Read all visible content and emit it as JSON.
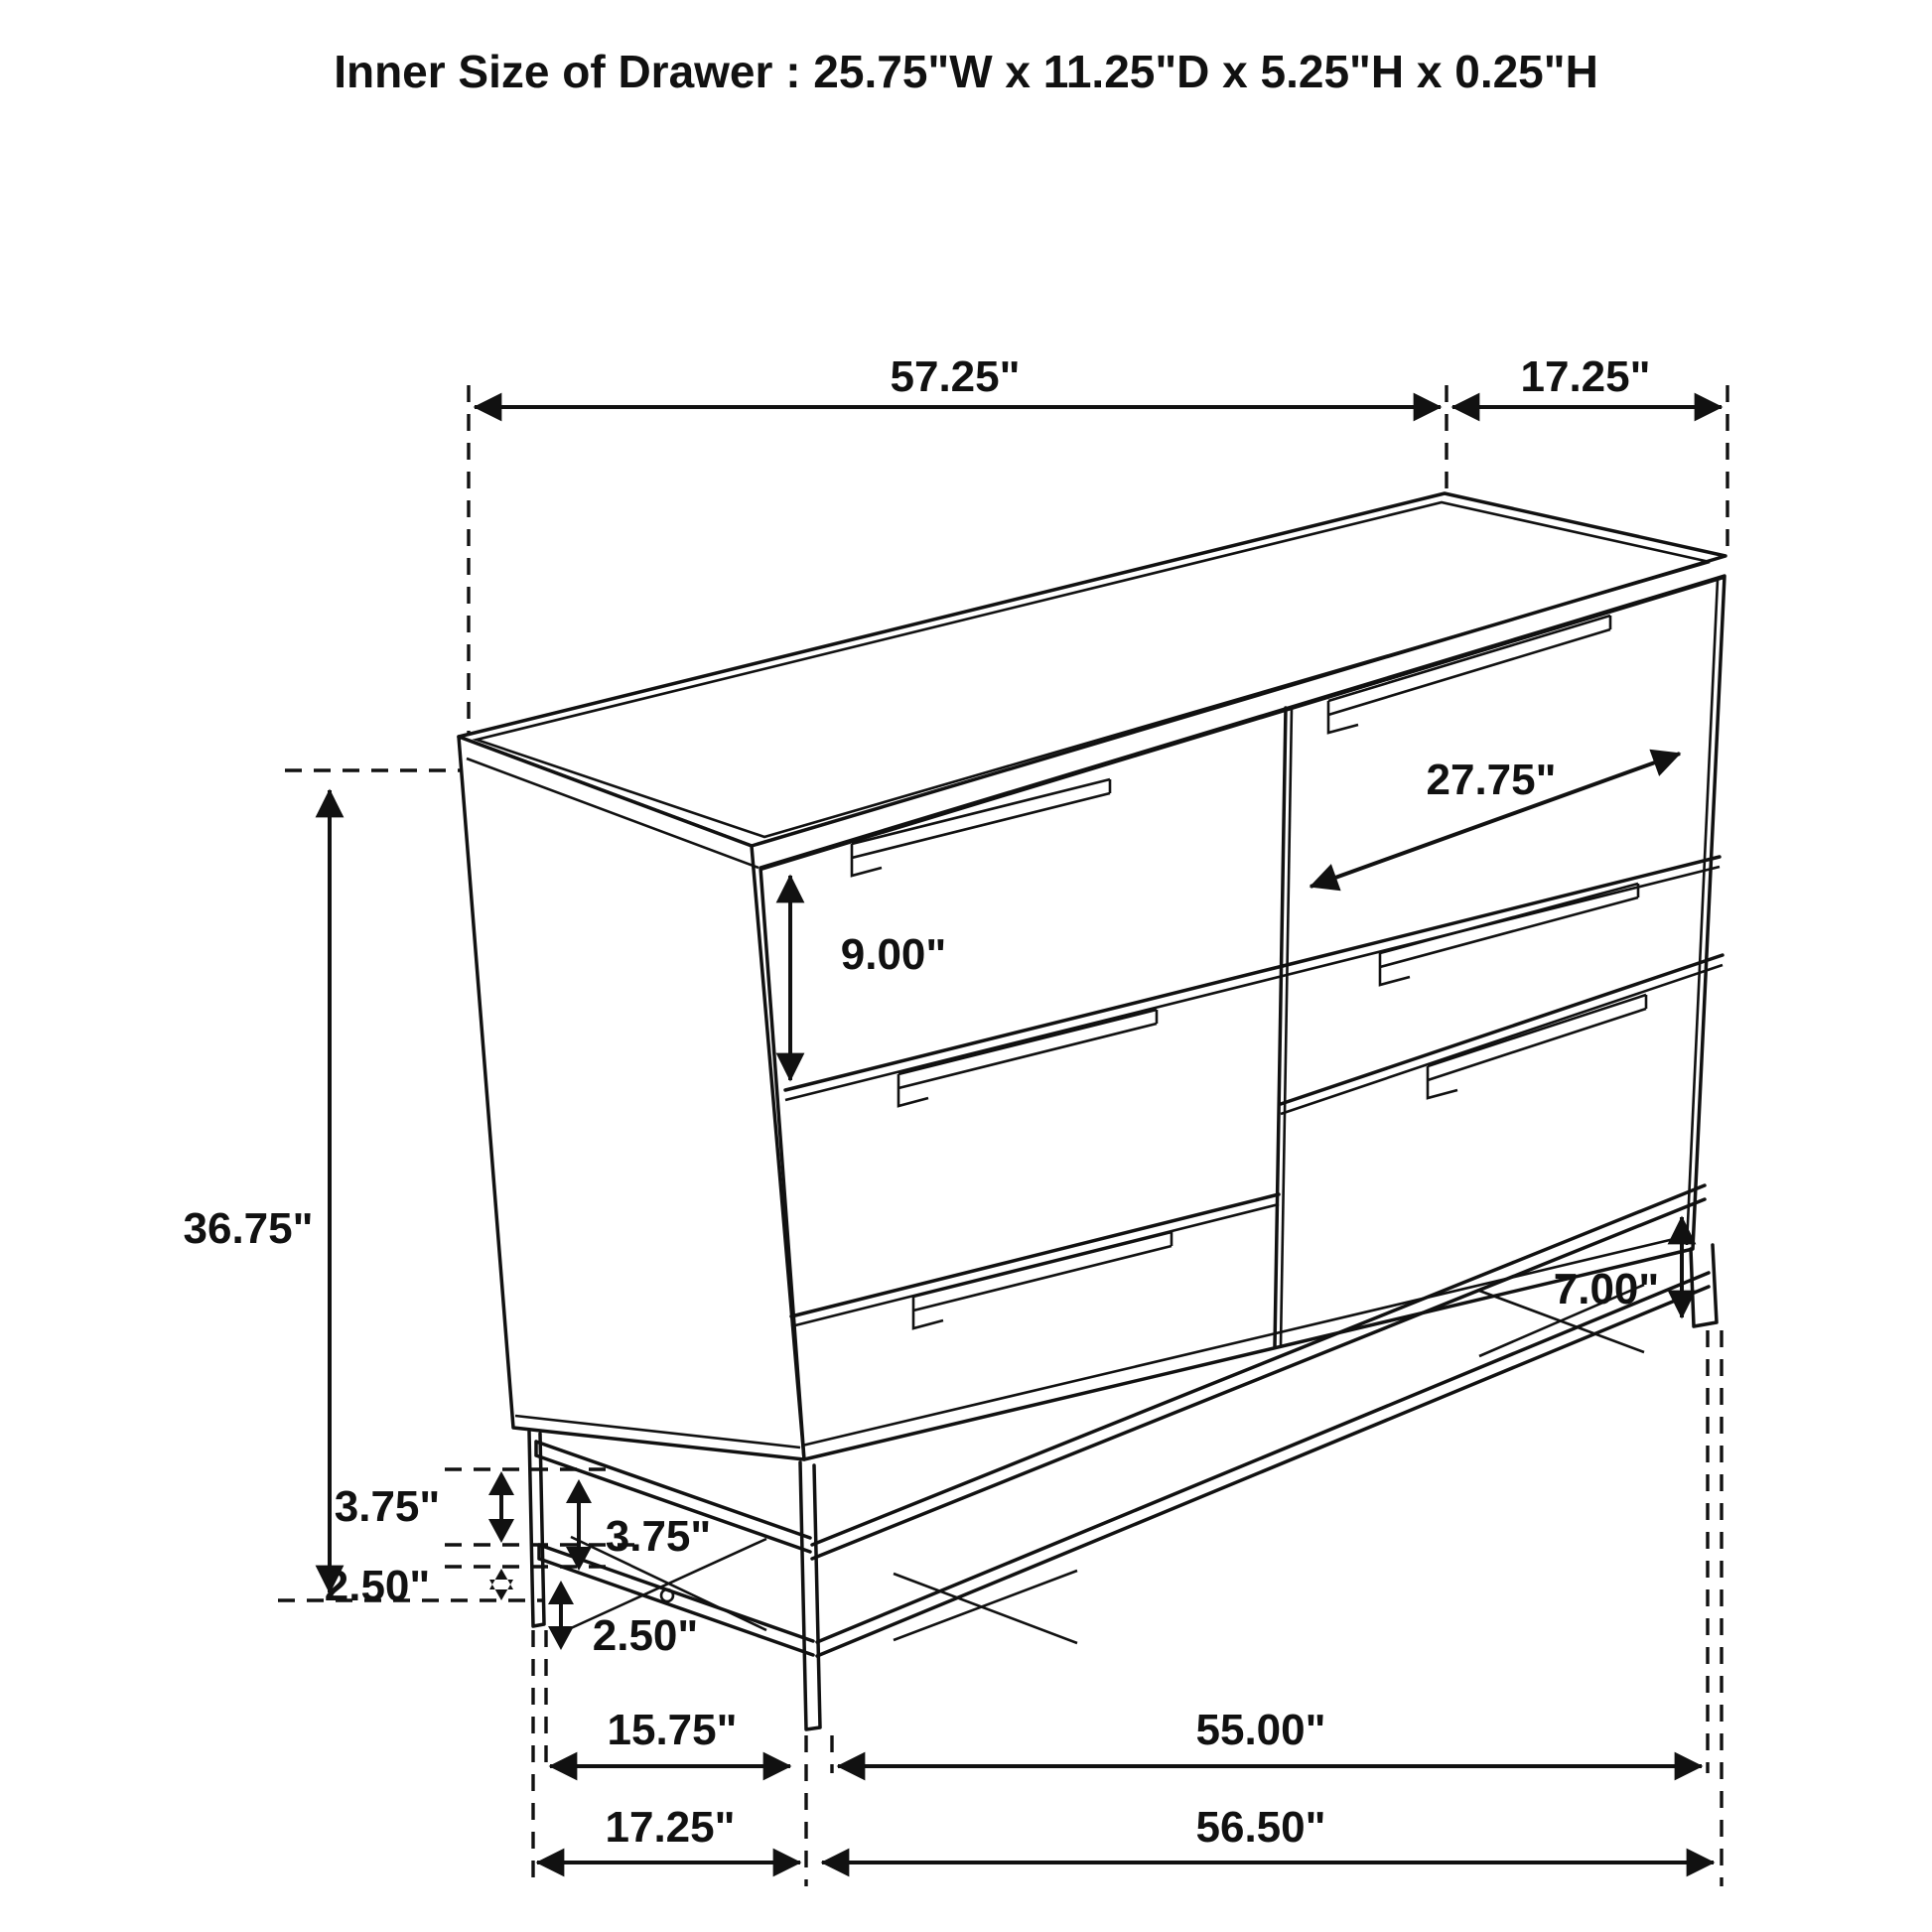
{
  "title": "Inner Size of Drawer : 25.75\"W x 11.25\"D x 5.25\"H x 0.25\"H",
  "dimensions": {
    "cabinet_width_top": "57.25\"",
    "cabinet_depth_top": "17.25\"",
    "top_drawer_front_height": "9.00\"",
    "drawer_front_diagonal": "27.75\"",
    "overall_height": "36.75\"",
    "upper_rail_offset_outer": "3.75\"",
    "upper_rail_offset_inner": "3.75\"",
    "lower_rail_offset_outer": "2.50\"",
    "lower_rail_offset_inner": "2.50\"",
    "base_clearance_right": "7.00\"",
    "base_depth_between_legs": "15.75\"",
    "base_width_between_legs": "55.00\"",
    "base_depth_overall": "17.25\"",
    "base_width_overall": "56.50\""
  },
  "colors": {
    "ink": "#111111",
    "background": "#ffffff"
  }
}
